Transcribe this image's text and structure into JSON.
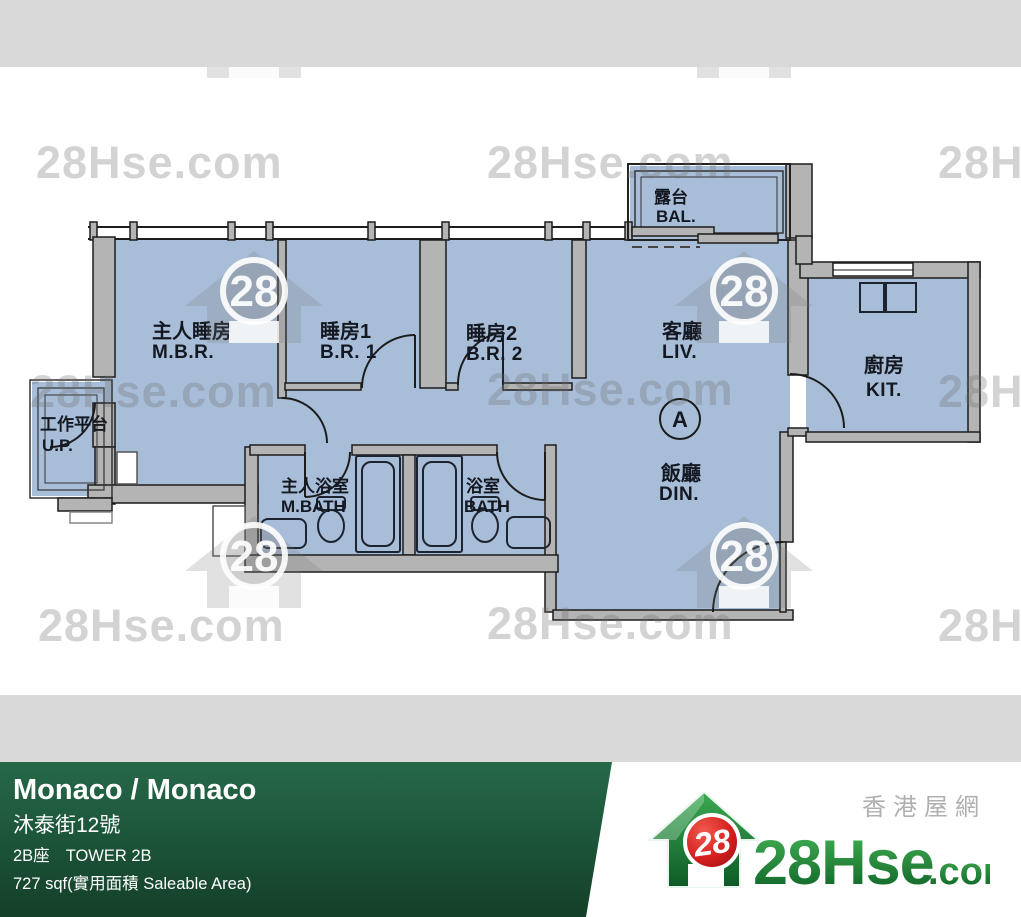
{
  "floor_plan": {
    "rooms": {
      "mbr": {
        "cn": "主人睡房",
        "en": "M.B.R."
      },
      "br1": {
        "cn": "睡房1",
        "en": "B.R. 1"
      },
      "br2": {
        "cn": "睡房2",
        "en": "B.R. 2"
      },
      "liv": {
        "cn": "客廳",
        "en": "LIV."
      },
      "din": {
        "cn": "飯廳",
        "en": "DIN."
      },
      "kit": {
        "cn": "廚房",
        "en": "KIT."
      },
      "bal": {
        "cn": "露台",
        "en": "BAL."
      },
      "up": {
        "cn": "工作平台",
        "en": "U.P."
      },
      "mbath": {
        "cn": "主人浴室",
        "en": "M.BATH"
      },
      "bath": {
        "cn": "浴室",
        "en": "BATH"
      }
    },
    "unit_marker": "A"
  },
  "watermark": {
    "text": "28Hse.com",
    "badge": "28"
  },
  "info_bar": {
    "title": "Monaco / Monaco",
    "address_cn": "沐泰街12號",
    "tower_cn": "2B座",
    "tower_en": "TOWER 2B",
    "area": "727 sqf(實用面積 Saleable Area)"
  },
  "logo": {
    "badge": "28",
    "brand_main": "28Hse",
    "brand_suffix": ".com",
    "tagline": "香港屋網"
  },
  "colors": {
    "room_fill": "#a8bed8",
    "wall_gray": "#b4b4b4",
    "band_gray": "#d9d9d9",
    "bar_green_top": "#27684a",
    "bar_green_bottom": "#143f28",
    "logo_green": "#1e8c3c",
    "badge_red": "#cc1a22",
    "watermark_gray": "#d6d6d6"
  }
}
